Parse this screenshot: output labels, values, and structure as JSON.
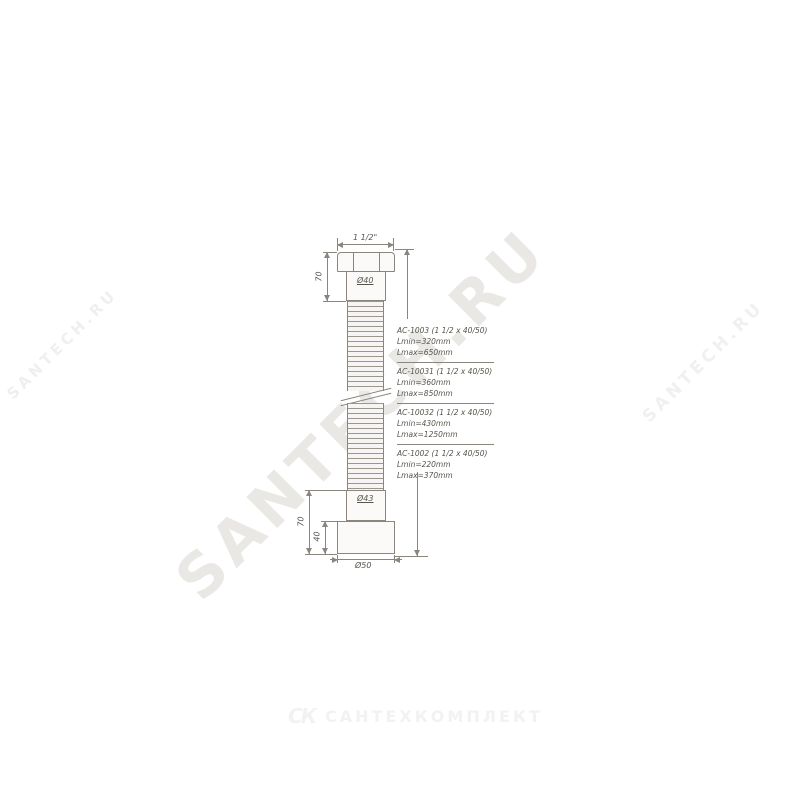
{
  "watermarks": {
    "center": "SANTECH.RU",
    "left": "SANTECH.RU",
    "right": "SANTECH.RU"
  },
  "footer_logo": {
    "monogram": "СК",
    "label": "САНТЕХКОМПЛЕКТ"
  },
  "drawing": {
    "dims": {
      "thread": "1 1/2\"",
      "neck_height": "70",
      "neck_diameter": "Ø40",
      "outlet_diameter": "Ø43",
      "outlet_height": "70",
      "cuff_height": "40",
      "cuff_diameter": "Ø50"
    },
    "variants": [
      {
        "code": "AC-1003 (1 1/2 x 40/50)",
        "lmin": "Lmin=320mm",
        "lmax": "Lmax=650mm"
      },
      {
        "code": "AC-10031 (1 1/2 x 40/50)",
        "lmin": "Lmin=360mm",
        "lmax": "Lmax=850mm"
      },
      {
        "code": "AC-10032 (1 1/2 x 40/50)",
        "lmin": "Lmin=430mm",
        "lmax": "Lmax=1250mm"
      },
      {
        "code": "AC-1002 (1 1/2 x 40/50)",
        "lmin": "Lmin=220mm",
        "lmax": "Lmax=370mm"
      }
    ]
  }
}
